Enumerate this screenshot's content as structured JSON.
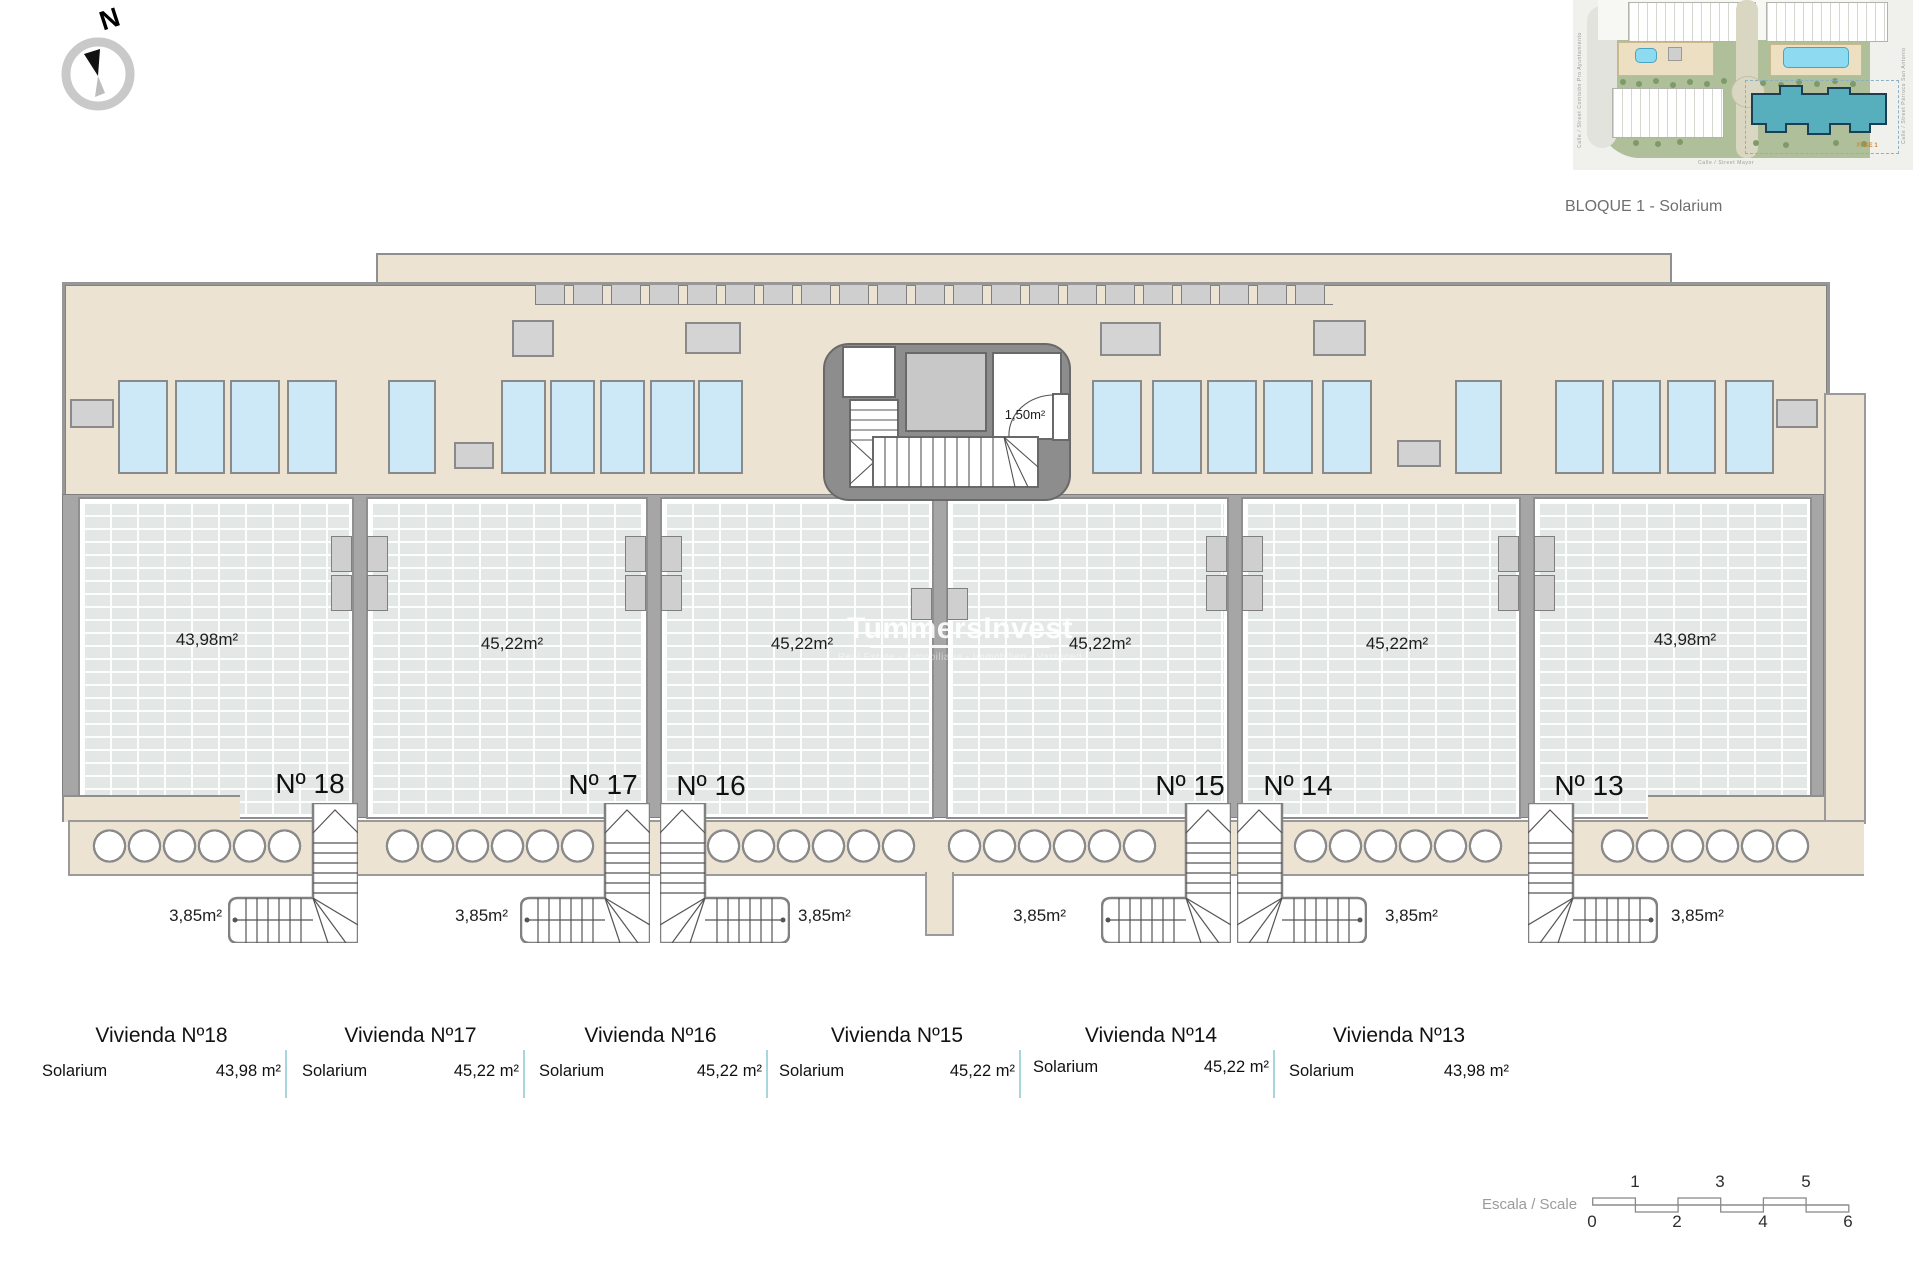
{
  "compass": {
    "label": "N"
  },
  "site_plan": {
    "caption": "BLOQUE 1 - Solarium",
    "phase_label": "FASE 1",
    "streets": {
      "left": "Calle / Street Comisión Pro Ayuntamiento",
      "right": "Calle / Street Párroco San Antonio",
      "bottom": "Calle / Street Mayor"
    }
  },
  "watermark": {
    "title": "TummersInvest",
    "subtitle": "Real Estate - Inmobiliaria - Immobilien - Vastgoed"
  },
  "core": {
    "storage_area": "1,50m²"
  },
  "units": [
    {
      "id": "18",
      "number": "Nº 18",
      "solarium_area": "43,98m²",
      "stair_area": "3,85m²"
    },
    {
      "id": "17",
      "number": "Nº 17",
      "solarium_area": "45,22m²",
      "stair_area": "3,85m²"
    },
    {
      "id": "16",
      "number": "Nº 16",
      "solarium_area": "45,22m²",
      "stair_area": "3,85m²"
    },
    {
      "id": "15",
      "number": "Nº 15",
      "solarium_area": "45,22m²",
      "stair_area": "3,85m²"
    },
    {
      "id": "14",
      "number": "Nº 14",
      "solarium_area": "45,22m²",
      "stair_area": "3,85m²"
    },
    {
      "id": "13",
      "number": "Nº 13",
      "solarium_area": "43,98m²",
      "stair_area": "3,85m²"
    }
  ],
  "legend": {
    "columns": [
      {
        "title": "Vivienda Nº18",
        "room": "Solarium",
        "value": "43,98 m²"
      },
      {
        "title": "Vivienda Nº17",
        "room": "Solarium",
        "value": "45,22 m²"
      },
      {
        "title": "Vivienda Nº16",
        "room": "Solarium",
        "value": "45,22 m²"
      },
      {
        "title": "Vivienda Nº15",
        "room": "Solarium",
        "value": "45,22 m²"
      },
      {
        "title": "Vivienda Nº14",
        "room": "Solarium",
        "value": "45,22 m²"
      },
      {
        "title": "Vivienda Nº13",
        "room": "Solarium",
        "value": "43,98 m²"
      }
    ]
  },
  "scale": {
    "label": "Escala / Scale",
    "ticks_top": [
      "1",
      "3",
      "5"
    ],
    "ticks_bottom": [
      "0",
      "2",
      "4",
      "6"
    ]
  },
  "colors": {
    "terrace": "#ece3d3",
    "tile": "#e3e8e7",
    "panel": "#cde9f7",
    "wall": "#a6a6a6",
    "legend_divider": "#a9d6da",
    "highlight_building": "#57aebc"
  }
}
